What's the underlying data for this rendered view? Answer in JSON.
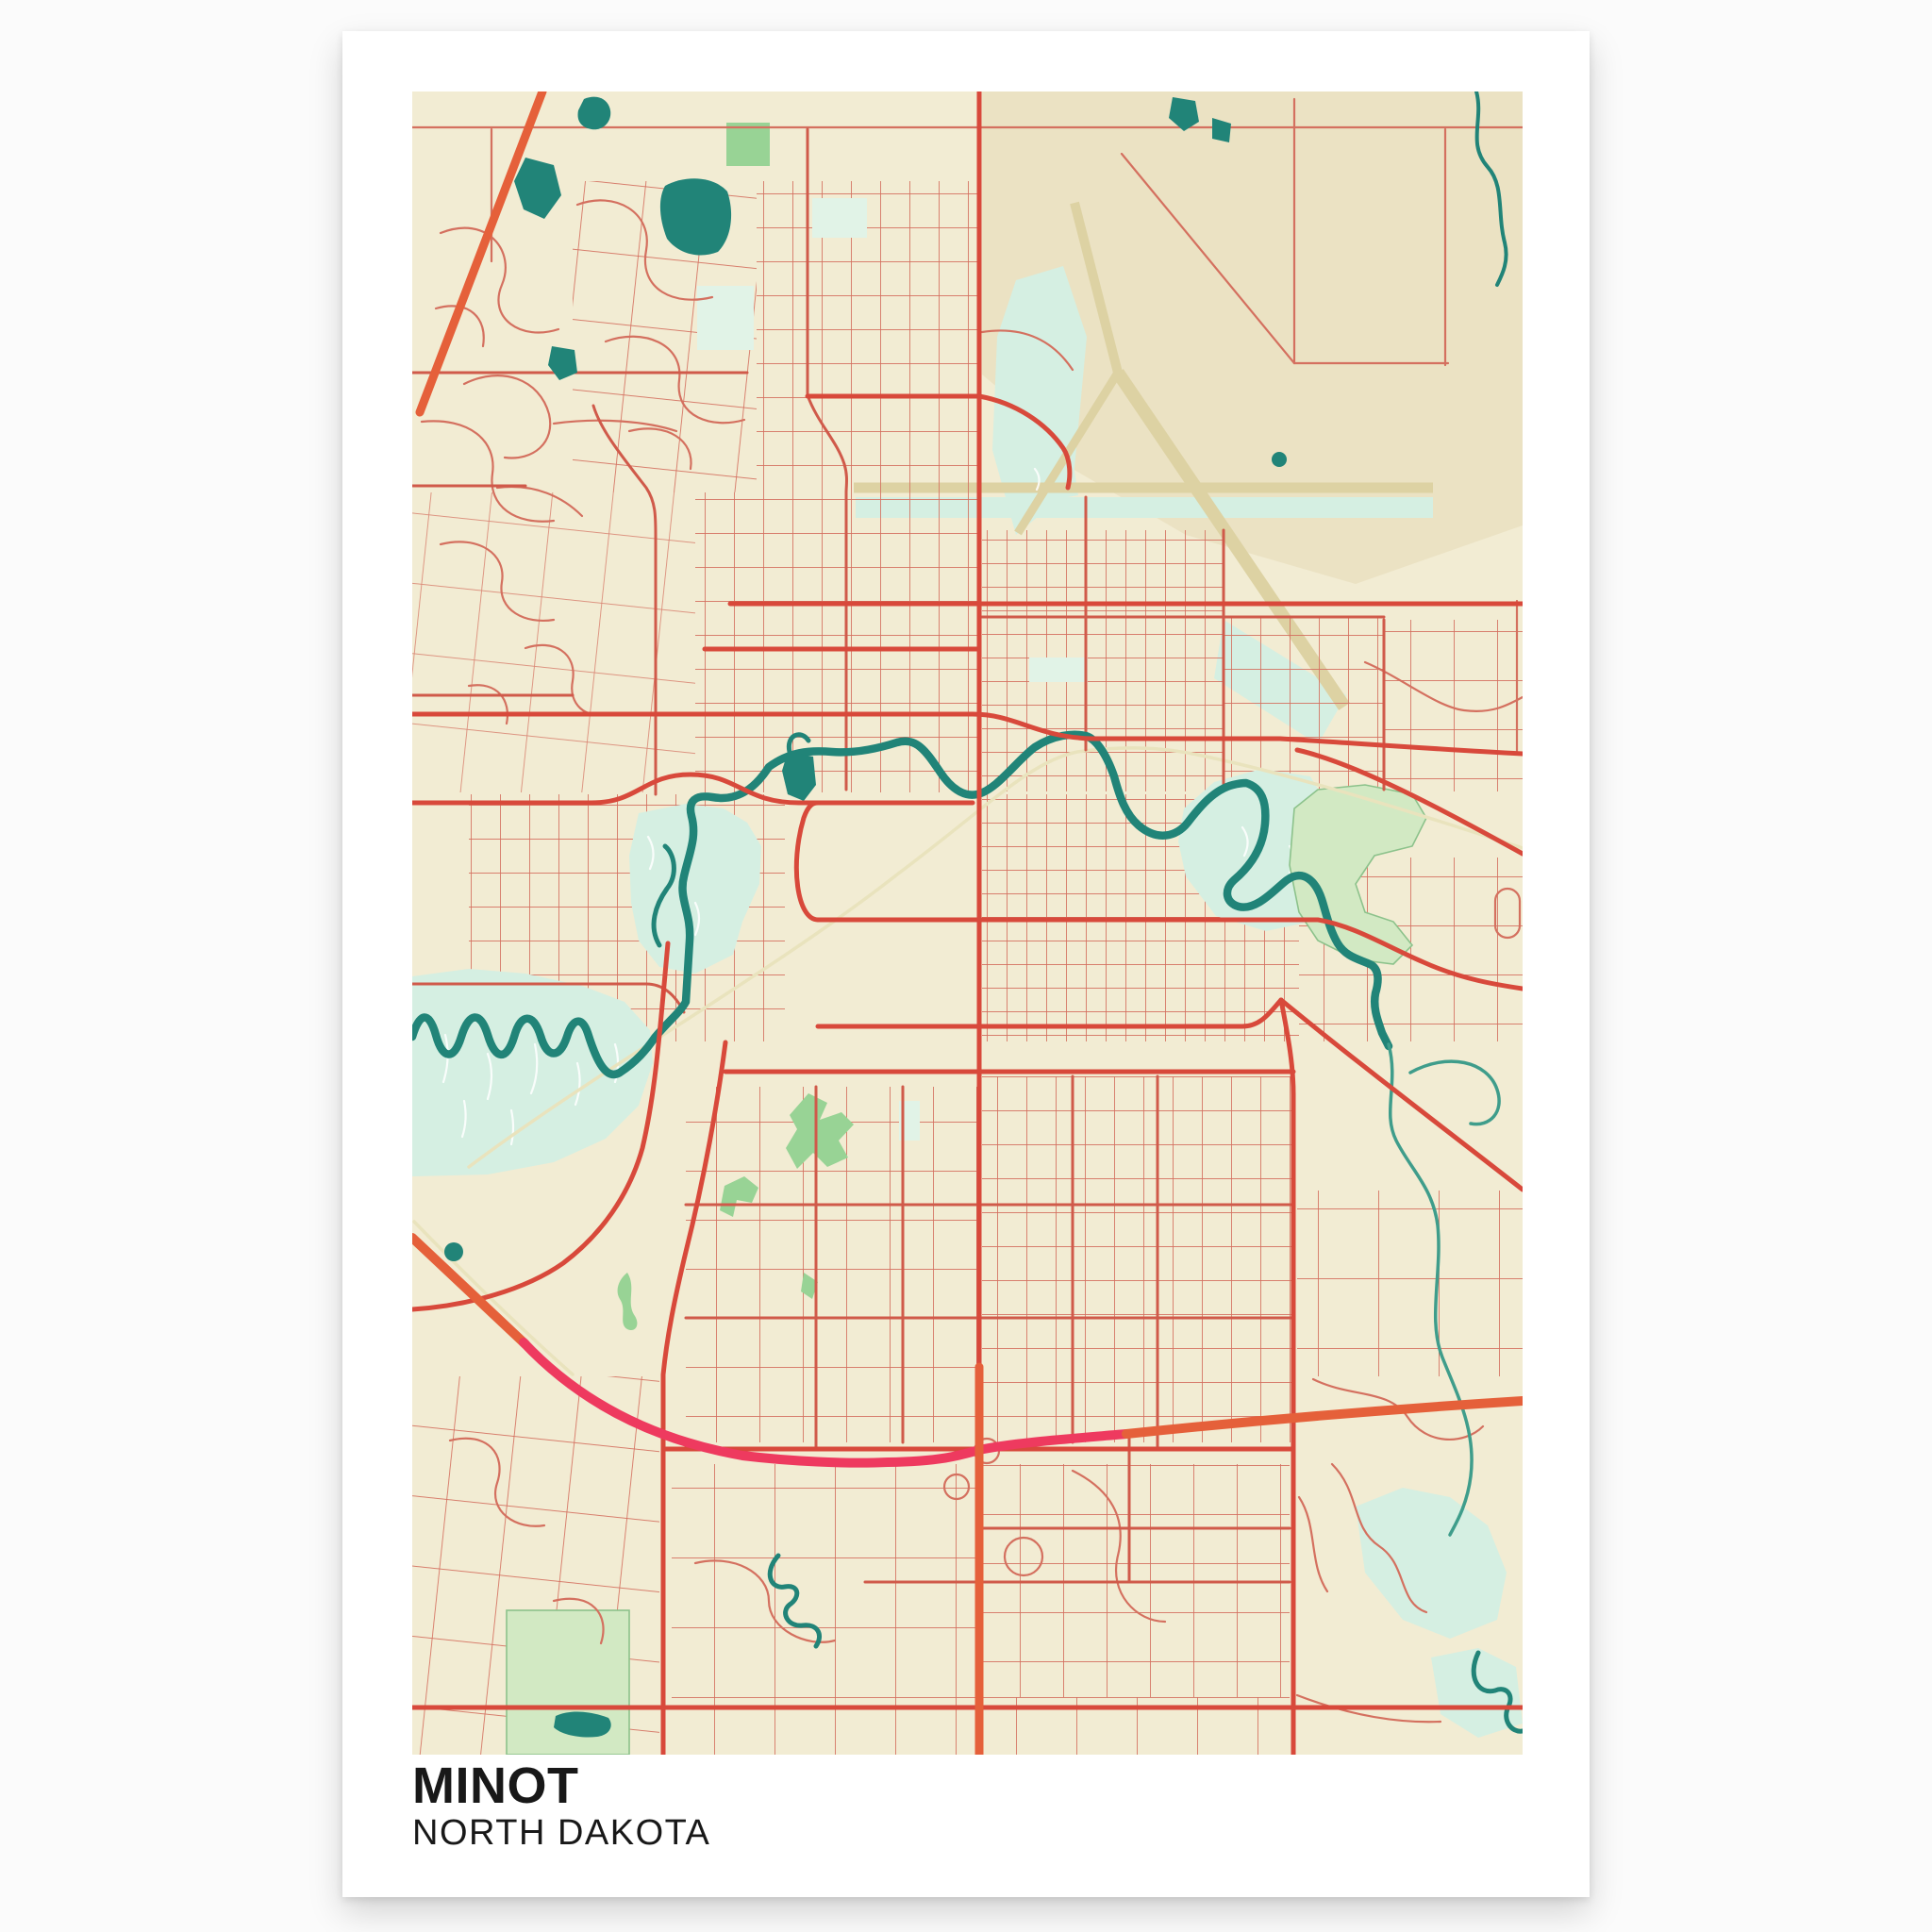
{
  "poster": {
    "title": "MINOT",
    "subtitle": "NORTH DAKOTA"
  },
  "palette": {
    "page": "#fbfbfb",
    "card": "#ffffff",
    "ink": "#181818",
    "land": "#f2ecd3",
    "land_tan": "#ebe2c3",
    "runway": "#ddd2a3",
    "water": "#218478",
    "water_soft": "#3f9d8b",
    "water_light": "#d5efe2",
    "mint_pale": "#e1f3e7",
    "park": "#98d395",
    "park_pale": "#d2e9c3",
    "park_outline": "#8cc28b",
    "road_minor": "#d4705f",
    "road_medium": "#d05a4a",
    "road_major": "#d8493b",
    "hwy_orange": "#e5603a",
    "hwy_pink": "#ee3a5f",
    "rail": "#e9e3bd",
    "white_wisp": "#ffffff"
  }
}
